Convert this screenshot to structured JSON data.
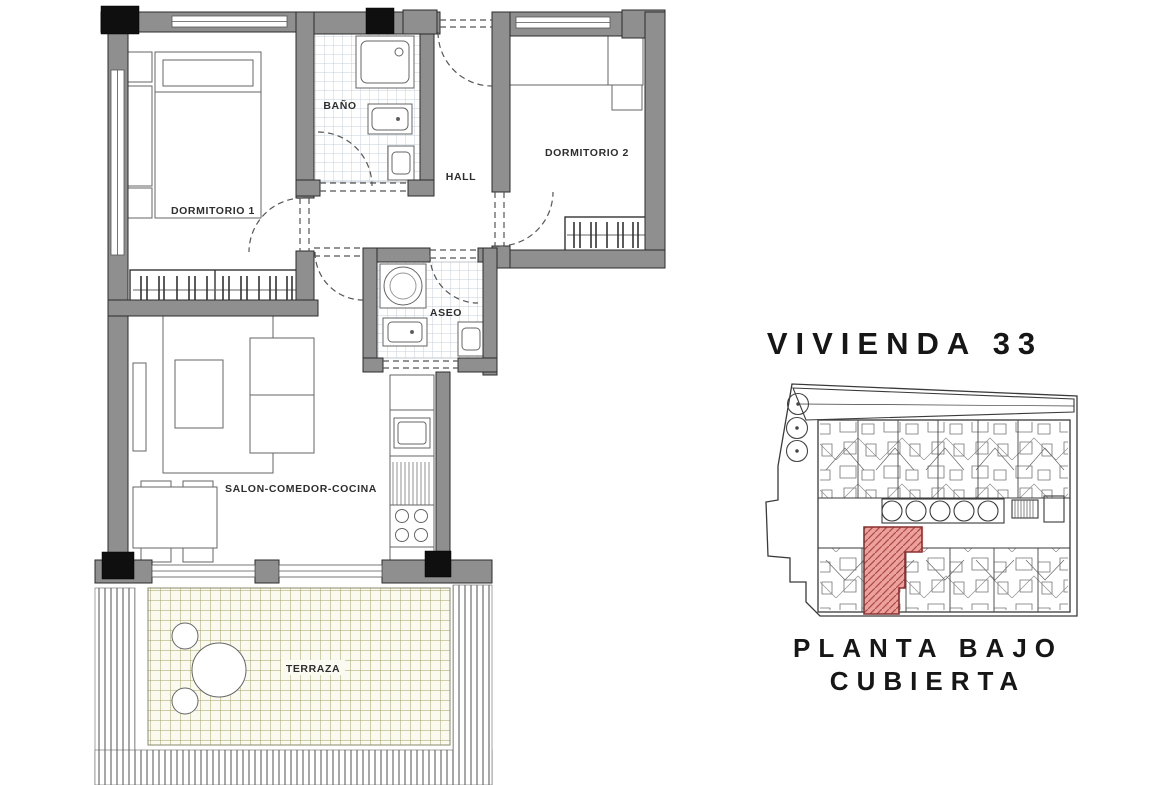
{
  "title": "VIVIENDA 33",
  "caption": {
    "line1": "PLANTA BAJO",
    "line2": "CUBIERTA"
  },
  "floorplan": {
    "labels": {
      "dormitorio1": "DORMITORIO 1",
      "bano": "BAÑO",
      "hall": "HALL",
      "dormitorio2": "DORMITORIO 2",
      "aseo": "ASEO",
      "salon": "SALON-COMEDOR-COCINA",
      "terraza": "TERRAZA"
    }
  },
  "colors": {
    "background": "#ffffff",
    "wall_fill": "#8f8f8f",
    "wall_line": "#2b2b2b",
    "column": "#0f0f0f",
    "bath_tile_line": "#c7cfdd",
    "terrace_tile_line": "#a2a263",
    "terrace_bg": "#fafaf0",
    "highlight_fill": "#eba29e",
    "highlight_hatch": "#b24a46",
    "text": "#1e1e1e"
  }
}
